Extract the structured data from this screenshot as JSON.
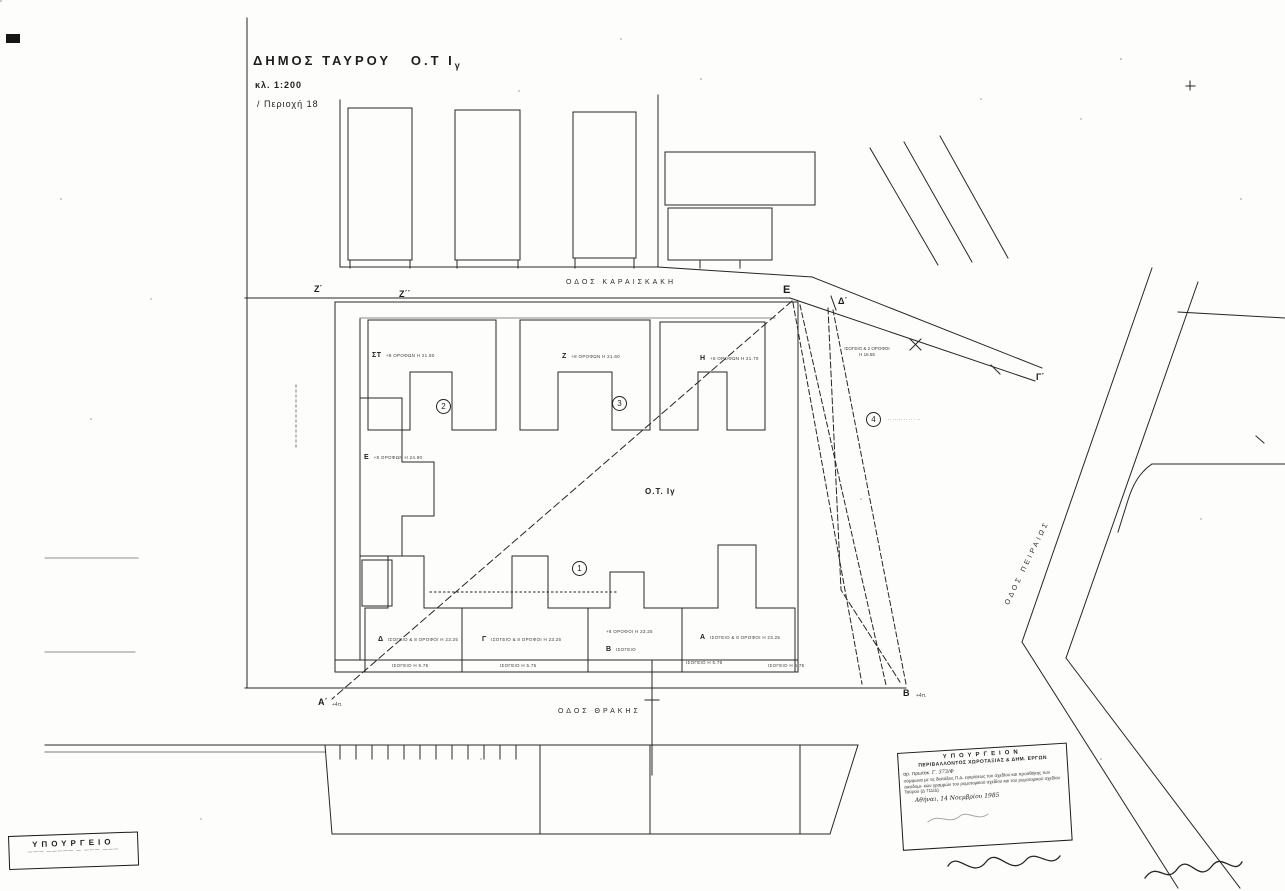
{
  "title": {
    "municipality": "ΔΗΜΟΣ ΤΑΥΡΟΥ",
    "block": "Ο.Τ Ι",
    "block_sub": "γ",
    "scale": "κλ. 1:200",
    "area": "/ Περιοχή 18"
  },
  "streets": {
    "top": "ΟΔΟΣ ΚΑΡΑΙΣΚΑΚΗ",
    "bottom": "ΟΔΟΣ ΘΡΑΚΗΣ",
    "right": "ΟΔΟΣ ΠΕΙΡΑΙΩΣ"
  },
  "block": {
    "label": "Ο.Τ. Ιγ"
  },
  "buildings": {
    "st": {
      "name": "ΣΤ",
      "info": "+8 ΟΡΟΦΩΝ Η 21.90"
    },
    "z": {
      "name": "Ζ",
      "info": "+8 ΟΡΟΦΩΝ Η 21.60"
    },
    "h": {
      "name": "Η",
      "info": "+8 ΟΡΟΦΩΝ Η 21.70"
    },
    "e": {
      "name": "Ε",
      "info": "+8 ΟΡΟΦΩΝ Η 24.90"
    },
    "d": {
      "name": "Δ",
      "info": "ΙΣΟΓΕΙΟ & 8 ΟΡΟΦΟΙ Η 23.25"
    },
    "g": {
      "name": "Γ",
      "info": "ΙΣΟΓΕΙΟ & 8 ΟΡΟΦΟΙ Η 23.25"
    },
    "b": {
      "name": "Β",
      "info": "+8 ΟΡΟΦΟΙ Η 23.25",
      "info2": "ΙΣΟΓΕΙΟ"
    },
    "a": {
      "name": "Α",
      "info": "ΙΣΟΓΕΙΟ & 8 ΟΡΟΦΟΙ Η 23.25"
    }
  },
  "ground_floor_note": "ΙΣΟΓΕΙΟ Η 5.75",
  "points": {
    "z1": "Ζ΄",
    "z2": "Ζ΄΄",
    "e": "Ε",
    "d1": "Δ΄",
    "g1": "Γ΄",
    "b": "Β",
    "b_note": "+4π.",
    "a1": "Α΄",
    "a1_note": "+4π."
  },
  "circled": {
    "c1": "1",
    "c2": "2",
    "c3": "3",
    "c4": "4"
  },
  "annotations": {
    "two_storey": "ΙΣΟΓΕΙΟ & 2 ΟΡΟΦΟΙ",
    "two_storey_h": "Η 16.55",
    "area4_note": "·· ····· ·· ·· · ··"
  },
  "stamp_right": {
    "line1": "ΥΠΟΥΡΓΕΙΟΝ",
    "line2": "ΠΕΡΙΒΑΛΛΟΝΤΟΣ ΧΩΡΟΤΑΞΙΑΣ & ΔΗΜ. ΕΡΓΩΝ",
    "line3": "αρ. πρωτοκ.",
    "line3_hand": "Γ. 373/Φ",
    "body1": "σύμφωνα με τις διατάξεις Π.Δ. εγκρίσεως",
    "body2": "του σχεδίου και προσθήκης των οικοδομι-",
    "body3": "κών γραμμών του ρυμοτομικού σχεδίου",
    "body4": "και του ρυμοτομικού σχεδίου Ταύρου",
    "body5": "(Δ 711/Δ)",
    "date": "Αθήναι, 14 Νοεμβρίου 1985"
  },
  "stamp_left": {
    "line1": "ΥΠΟΥΡΓΕΙΟ",
    "line2": "——— ————— — ——— ———"
  }
}
